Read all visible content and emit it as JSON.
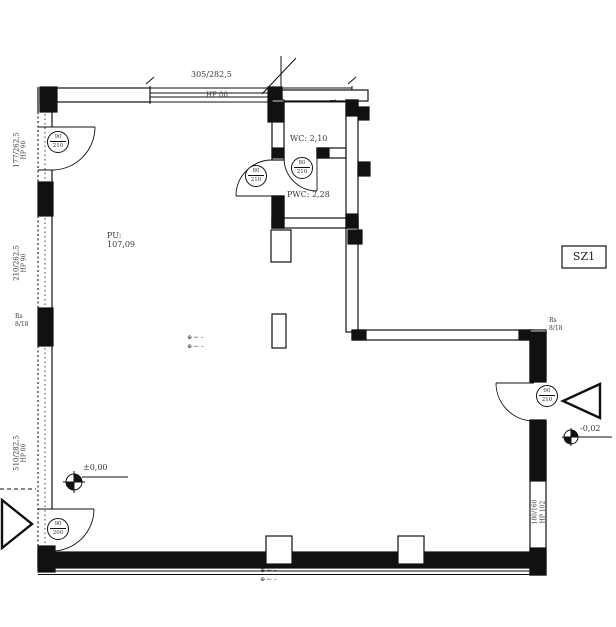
{
  "plan": {
    "rooms": {
      "main_name": "PU:",
      "main_area": "107,09",
      "wc": "WC: 2,10",
      "pwc": "PWC: 2,28"
    },
    "openings": {
      "top_dim": "305/282,5",
      "top_hp": "HP 00",
      "left_upper_dim": "177/262,5",
      "left_upper_hp": "HP 90",
      "left_mid_dim": "210/262,5",
      "left_mid_hp": "HP 90",
      "left_lower_dim": "510/282,5",
      "left_lower_hp": "HP 00",
      "right_dim": "180/160",
      "right_hp": "HP 102"
    },
    "columns": {
      "left_l1": "Rs",
      "left_l2": "8/18",
      "right_l1": "Rs",
      "right_l2": "8/18"
    },
    "doors": {
      "entry_top_w": "90",
      "entry_top_h": "210",
      "pwc_w": "80",
      "pwc_h": "210",
      "wc_w": "80",
      "wc_h": "210",
      "entry_bottom_w": "90",
      "entry_bottom_h": "200",
      "entry_right_w": "90",
      "entry_right_h": "210"
    },
    "levels": {
      "main": "±0,00",
      "entry": "-0,02"
    },
    "section_label": "SZ1",
    "annotations": {
      "mid_row1": "⊕ ← –",
      "mid_row2": "⊕ ← –",
      "bottom_row1": "⊕ ← –",
      "bottom_row2": "⊕ ← –",
      "top_arrow": "→"
    }
  }
}
